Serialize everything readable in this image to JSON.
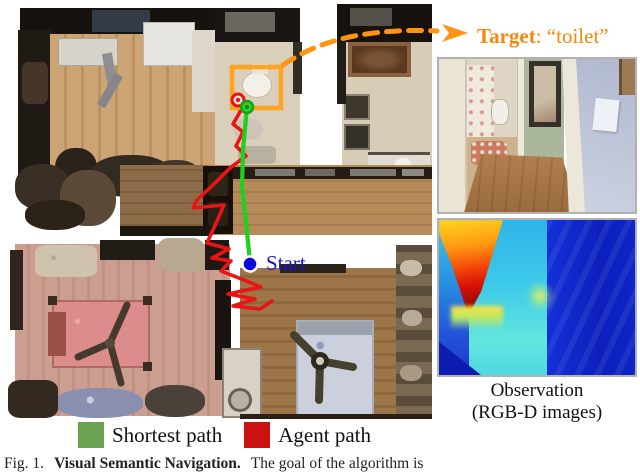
{
  "annotations": {
    "target": {
      "keyword": "Target",
      "rest": ": “toilet”"
    },
    "start": {
      "label": "Start"
    }
  },
  "observation_panel": {
    "caption_line1": "Observation",
    "caption_line2": "(RGB-D images)"
  },
  "legend": {
    "items": [
      {
        "label": "Shortest path",
        "color": "#6ba353"
      },
      {
        "label": "Agent path",
        "color": "#cc1111"
      }
    ]
  },
  "figure_caption": {
    "fig_label": "Fig. 1.",
    "title": "Visual Semantic Navigation.",
    "text": "The goal of the algorithm is"
  },
  "colors": {
    "target_orange": "#ff9413",
    "shortest_path_line": "#1fd11f",
    "agent_path_line": "#ea1414",
    "start_blue": "#1515cd"
  }
}
